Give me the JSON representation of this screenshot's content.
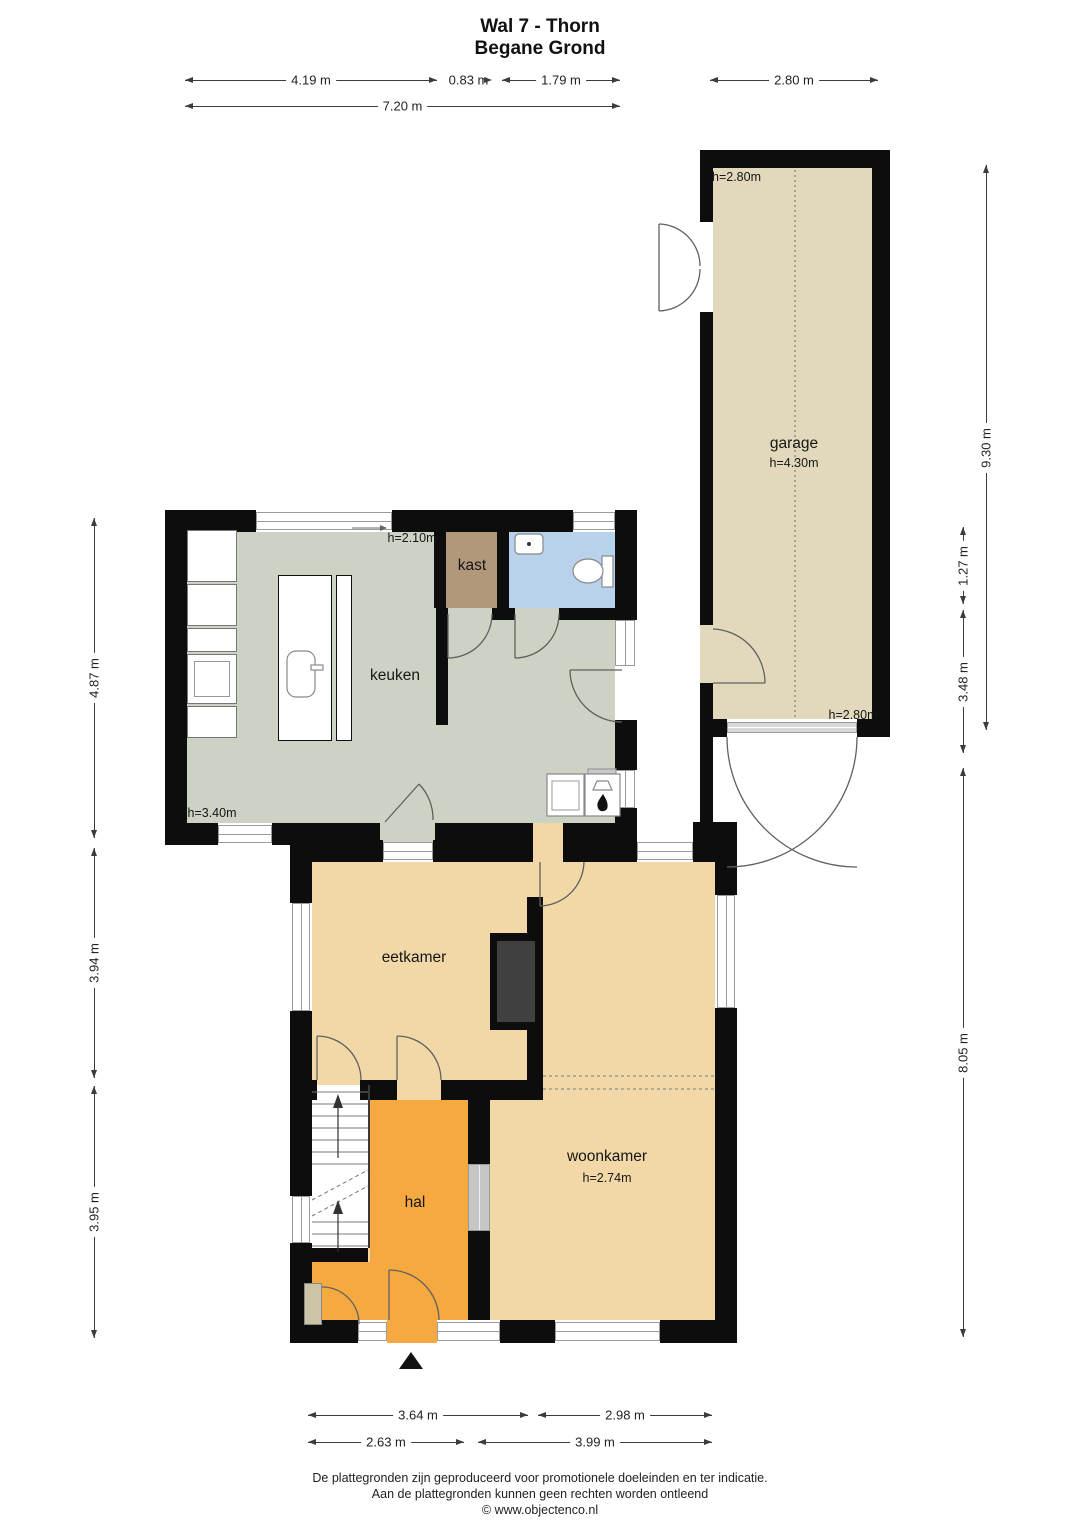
{
  "title": {
    "line1": "Wal 7 - Thorn",
    "line2": "Begane Grond"
  },
  "rooms": {
    "garage": {
      "label": "garage",
      "height": "h=4.30m",
      "ceiling_front": "h=2.80m",
      "ceiling_back": "h=2.80m"
    },
    "keuken": {
      "label": "keuken",
      "height": "h=3.40m",
      "closet_height": "h=2.10m"
    },
    "kast": {
      "label": "kast"
    },
    "eetkamer": {
      "label": "eetkamer"
    },
    "woonkamer": {
      "label": "woonkamer",
      "height": "h=2.74m"
    },
    "hal": {
      "label": "hal"
    }
  },
  "dimensions": {
    "top": [
      "4.19 m",
      "0.83 m",
      "1.79 m",
      "2.80 m",
      "7.20 m"
    ],
    "left": [
      "4.87 m",
      "3.94 m",
      "3.95 m"
    ],
    "right": [
      "9.30 m",
      "1.27 m",
      "3.48 m",
      "8.05 m"
    ],
    "bottom": [
      "3.64 m",
      "2.98 m",
      "2.63 m",
      "3.99 m"
    ]
  },
  "footer": {
    "line1": "De plattegronden zijn geproduceerd voor promotionele doeleinden en ter indicatie.",
    "line2": "Aan de plattegronden kunnen geen rechten worden ontleend",
    "line3": "© www.objectenco.nl"
  },
  "colors": {
    "wall": "#0d0d0d",
    "keuken_floor": "#ccd3c5",
    "garage_floor": "#e2d9bc",
    "living_floor": "#f2d8a7",
    "hal_floor": "#f6a841",
    "bathroom_floor": "#b9d2ec",
    "kast_floor": "#b1987a",
    "chimney": "#404040",
    "dim_line": "#3c3c3c"
  }
}
